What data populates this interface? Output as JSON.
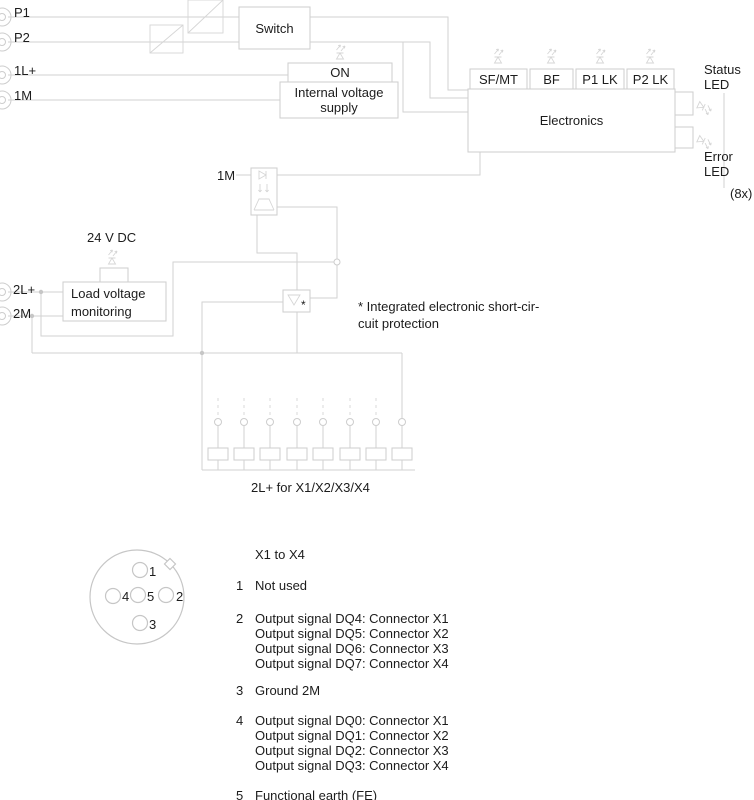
{
  "colors": {
    "line": "#d2d2d2",
    "text": "#1c1c1c",
    "background": "#ffffff"
  },
  "icons": {
    "led": "led-indicator-icon",
    "isolation": "isolation-slash-icon",
    "optocoupler": "optocoupler-icon",
    "short_circuit_protection": "triangle-limiter-icon",
    "connector_socket": "socket-circle-icon"
  },
  "left_terminals": {
    "p1": "P1",
    "p2": "P2",
    "l1": "1L+",
    "m1": "1M",
    "l2": "2L+",
    "m2": "2M"
  },
  "blocks": {
    "switch": "Switch",
    "on": "ON",
    "ivs_line1": "Internal voltage",
    "ivs_line2": "supply",
    "electronics": "Electronics",
    "lvm_line1": "Load voltage",
    "lvm_line2": "monitoring"
  },
  "led_labels": {
    "sfmt": "SF/MT",
    "bf": "BF",
    "p1lk": "P1 LK",
    "p2lk": "P2 LK"
  },
  "right_labels": {
    "status_1": "Status",
    "status_2": "LED",
    "error_1": "Error",
    "error_2": "LED",
    "count": "(8x)"
  },
  "mid_labels": {
    "m1_opto": "1M",
    "supply_24v": "24 V DC",
    "asterisk": "*",
    "note_line1": "* Integrated electronic short-cir-",
    "note_line2": "cuit protection",
    "bus_label": "2L+ for X1/X2/X3/X4"
  },
  "pinout": {
    "pin_labels": [
      "1",
      "2",
      "3",
      "4",
      "5"
    ]
  },
  "legend": {
    "header": "X1 to X4",
    "groups": [
      {
        "num": "1",
        "lines": [
          "Not used"
        ]
      },
      {
        "num": "2",
        "lines": [
          "Output signal DQ4: Connector X1",
          "Output signal DQ5: Connector X2",
          "Output signal DQ6: Connector X3",
          "Output signal DQ7: Connector X4"
        ]
      },
      {
        "num": "3",
        "lines": [
          "Ground 2M"
        ]
      },
      {
        "num": "4",
        "lines": [
          "Output signal DQ0: Connector X1",
          "Output signal DQ1: Connector X2",
          "Output signal DQ2: Connector X3",
          "Output signal DQ3: Connector X4"
        ]
      },
      {
        "num": "5",
        "lines": [
          "Functional earth (FE)"
        ]
      }
    ]
  }
}
